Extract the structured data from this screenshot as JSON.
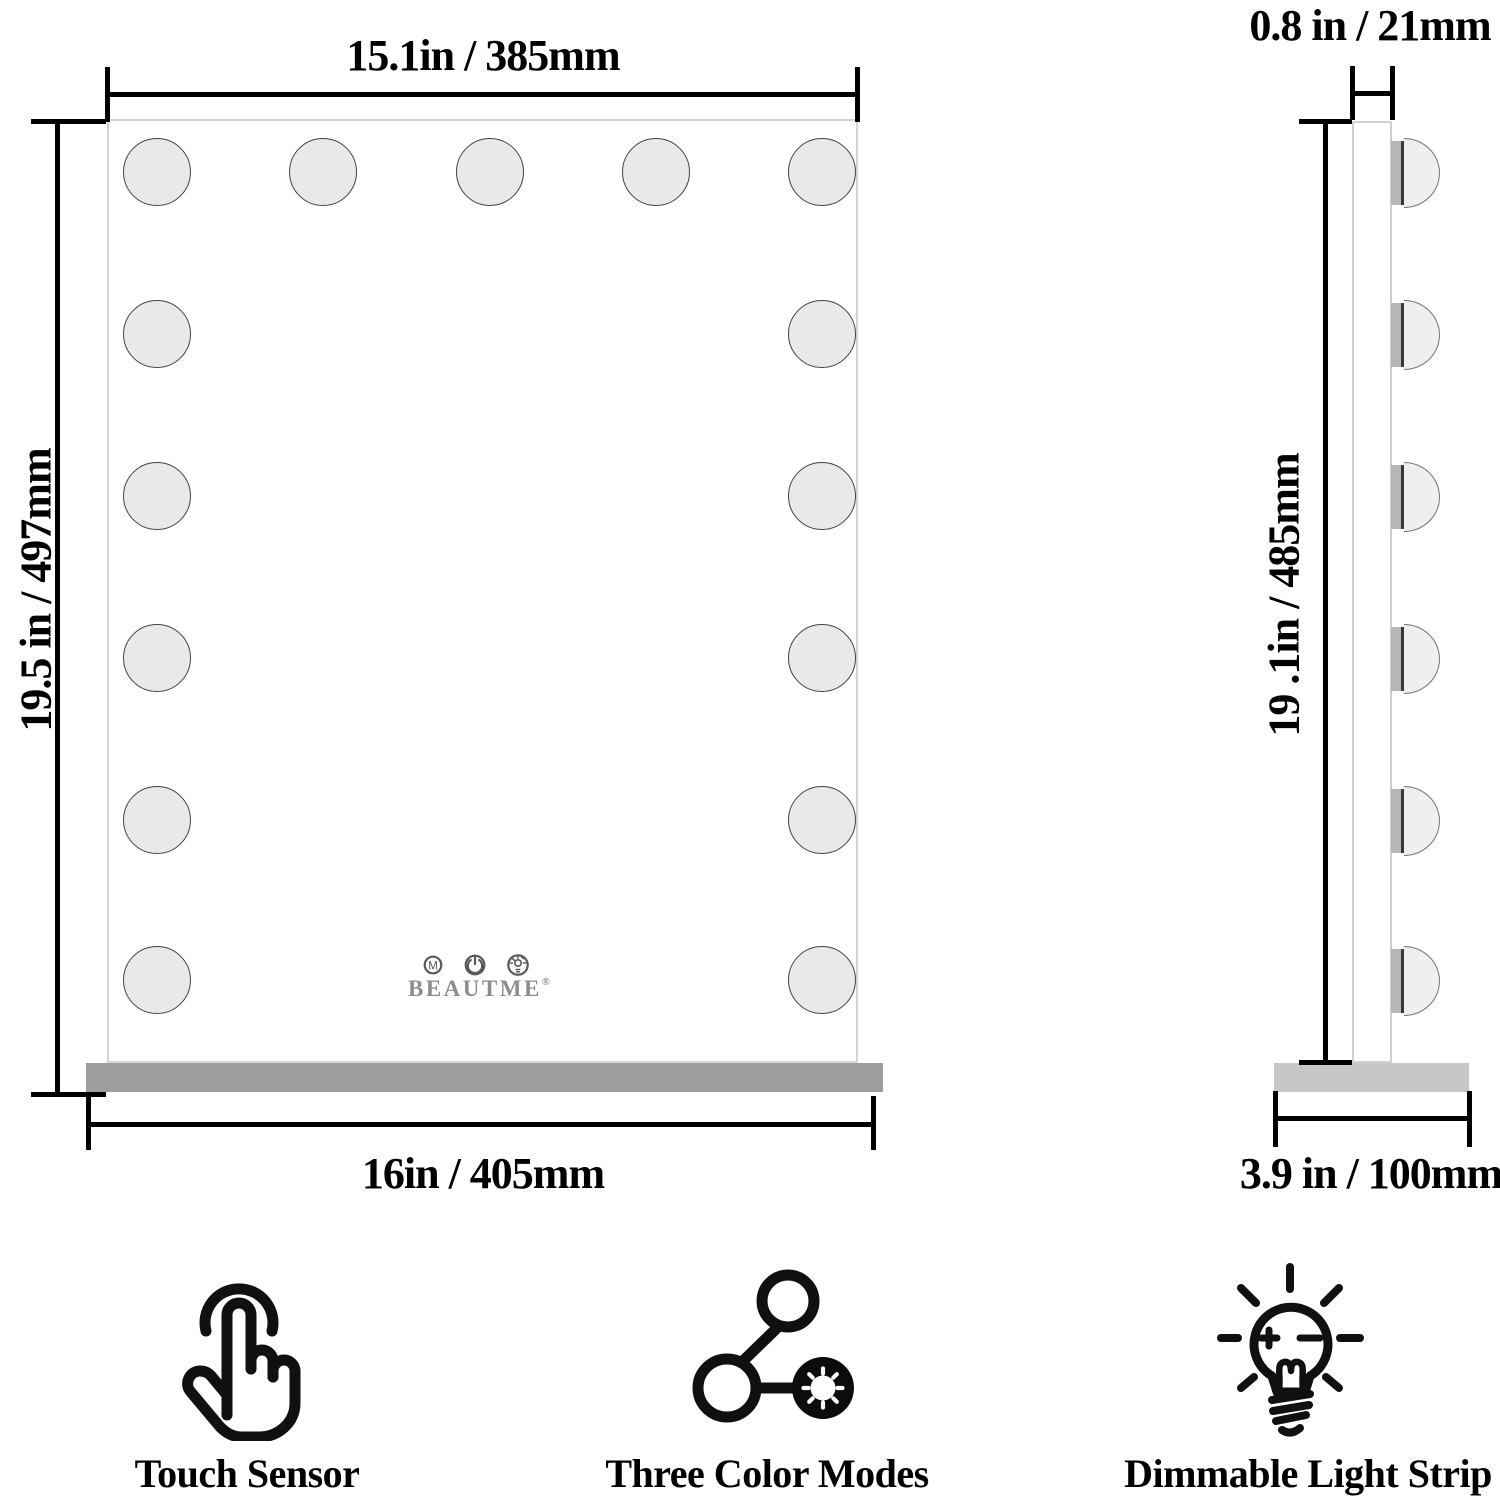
{
  "front_view": {
    "dim_width_top": "15.1in / 385mm",
    "dim_height_left": "19.5 in / 497mm",
    "dim_width_bottom": "16in / 405mm",
    "light_bulb_count": 15,
    "controls": {
      "mode_letter": "M",
      "power_icon": "power-symbol",
      "brightness_icon": "bulb-brightness-symbol",
      "brand": "BEAUTME",
      "registered_mark": "®"
    }
  },
  "side_view": {
    "dim_depth_top": "0.8 in / 21mm",
    "dim_height_left": "19 .1in / 485mm",
    "dim_depth_bottom": "3.9 in / 100mm",
    "light_bulb_count": 6
  },
  "features": [
    {
      "icon": "touch-sensor-icon",
      "label": "Touch Sensor"
    },
    {
      "icon": "three-color-modes-icon",
      "label": "Three Color Modes"
    },
    {
      "icon": "dimmable-light-strip-icon",
      "label": "Dimmable Light Strip"
    }
  ],
  "colors": {
    "dimension_line": "#000000",
    "bulb_fill": "#e9e9e9",
    "bulb_outline": "#424242",
    "front_base_gray": "#9e9e9e",
    "side_base_gray": "#c7c7c7",
    "brand_gray": "#8d8d8d",
    "mirror_border": "#d5d5d5"
  }
}
